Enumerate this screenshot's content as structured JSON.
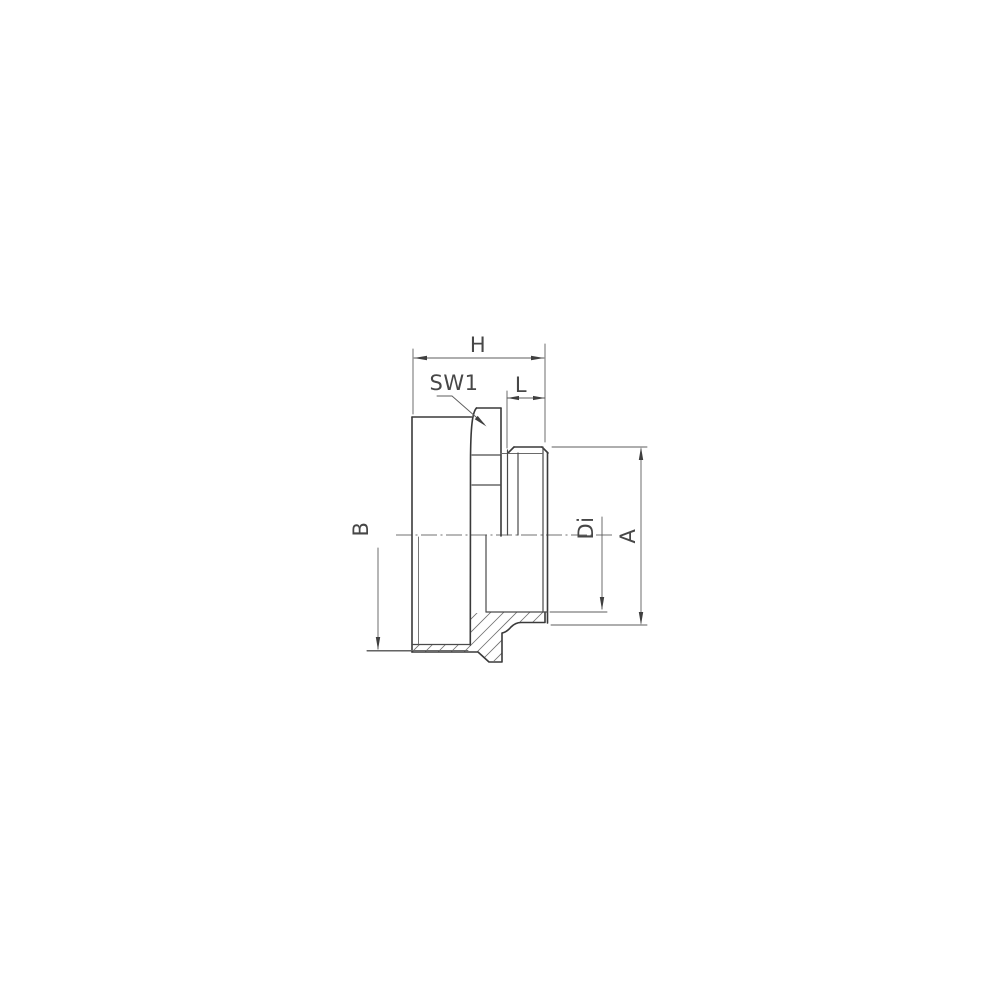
{
  "drawing": {
    "type": "technical-dimension-drawing",
    "labels": {
      "overall_length": "H",
      "wrench_size": "SW1",
      "thread_length": "L",
      "body_thread": "B",
      "inner_diameter": "Di",
      "outer_diameter": "A"
    },
    "colors": {
      "line": "#3a3a3a",
      "dimension": "#5d5d5d",
      "background": "#ffffff"
    }
  }
}
